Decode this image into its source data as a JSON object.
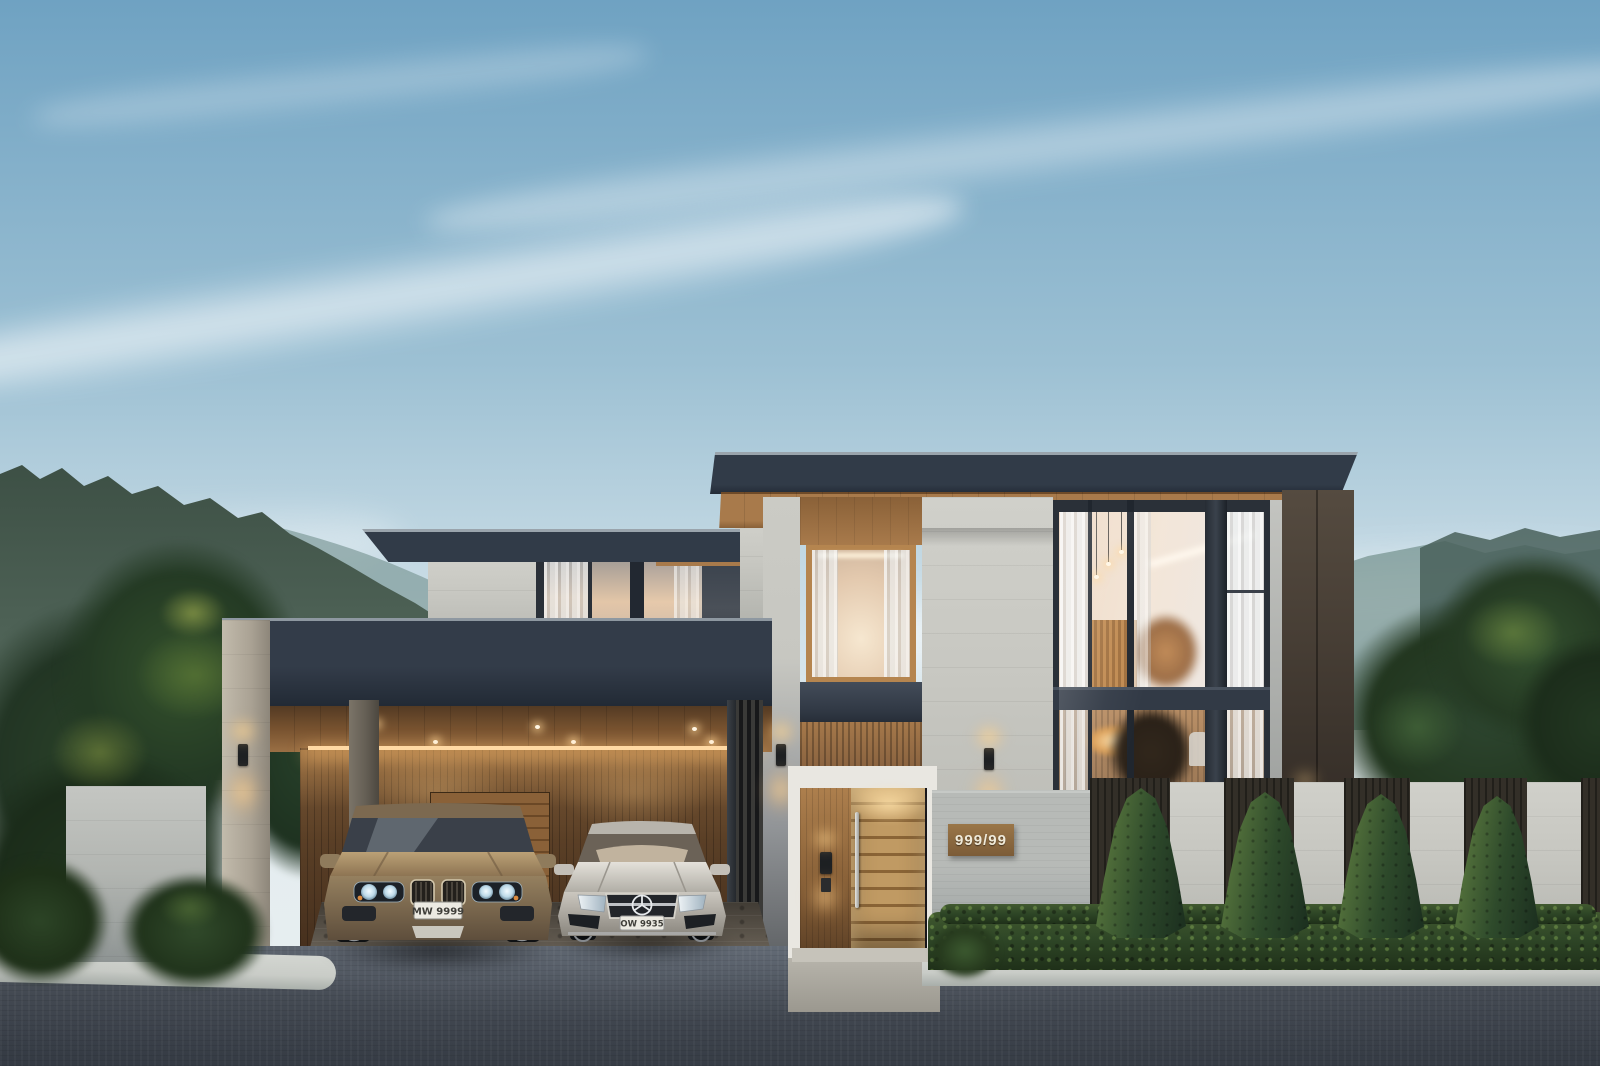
{
  "entrance": {
    "house_number": "999/99"
  },
  "cars": [
    {
      "name": "champagne-suv",
      "license_plate": "MW 9999",
      "body_color": "#9a8466"
    },
    {
      "name": "silver-sedan",
      "license_plate": "OW 9935",
      "body_color": "#cdc9c1"
    }
  ],
  "colors": {
    "sky-top": "#6fa2c2",
    "sky-mid": "#9cc0d3",
    "sky-low": "#cfe0e8",
    "mtn": "#44584c",
    "mtn-far": "#72908c",
    "leaf-dark": "#243824",
    "leaf-mid": "#33502c",
    "leaf-light": "#6e8a3e",
    "roof": "#313b48",
    "roof-edge": "#9aa4ac",
    "soffit": "#a87a4b",
    "stone": "#c7c7c1",
    "fence-wall": "#b7bab7",
    "wood-slat": "#8a6340",
    "wood-dark": "#4a3420",
    "led": "#ffd9a4",
    "door-wood": "#c09a63",
    "portal": "#e9e7e1",
    "glass-warm": "#e9cdb2",
    "glass-cool": "#b9c4cc",
    "frame": "#2a3038",
    "bronze": "#473e35",
    "asphalt": "#454b54",
    "asphalt-dark": "#363c45",
    "cobble": "#6b645a",
    "curb": "#c9ccc7",
    "hedge": "#2f4727",
    "cypress": "#2e4a2b",
    "glow-warm": "#ffc988",
    "plate-bg": "#eceae2",
    "plate-text": "#3f3e39"
  }
}
